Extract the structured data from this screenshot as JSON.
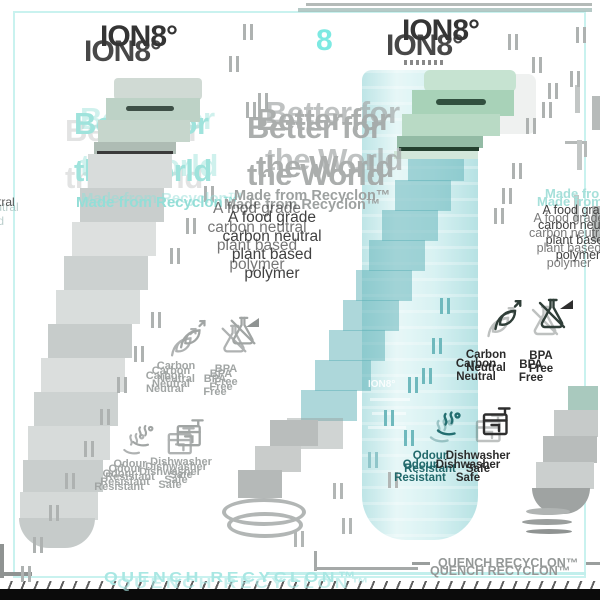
{
  "brand": {
    "logo": "ION8°",
    "accent_digit": "8"
  },
  "heading": {
    "line1": "Better for",
    "line2": "the World"
  },
  "subheading": "Made from Recyclon™",
  "body": {
    "line1": "A food grade",
    "line2": "carbon neutral",
    "line3": "plant based",
    "line4": "polymer"
  },
  "features": [
    {
      "icon": "leaf-carbon-neutral-icon",
      "line1": "Carbon",
      "line2": "Neutral"
    },
    {
      "icon": "flask-bpa-free-icon",
      "line1": "BPA",
      "line2": "Free"
    },
    {
      "icon": "scent-odour-icon",
      "line1": "Odour",
      "line2": "Resistant"
    },
    {
      "icon": "dishwasher-icon",
      "line1": "Dishwasher",
      "line2": "Safe"
    }
  ],
  "footer": {
    "text": "QUENCH RECYCLON™"
  },
  "colors": {
    "teal_heading": "#9fe3dc",
    "teal_accent": "#7de9e2",
    "bottle_teal": "#9fd9db",
    "cap_mint": "#a8d2b8",
    "ghost_gray": "#a2a6a5",
    "dark_text": "#3f3f3f",
    "teal_dark_label": "#236e70",
    "border_teal": "#c9f2ef",
    "black_bar": "#0b0b0b"
  }
}
